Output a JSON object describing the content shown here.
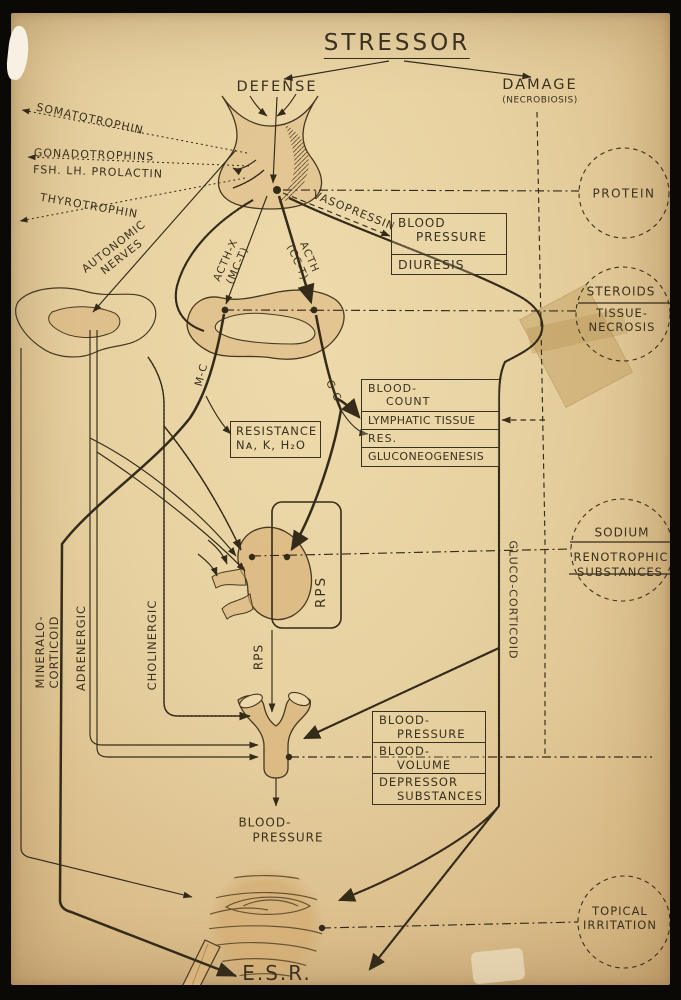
{
  "colors": {
    "paper": "#e7d1a1",
    "ink": "#352b1b",
    "organ_fill": "#d9b47c",
    "frame": "#0b0906"
  },
  "title": {
    "text": "STRESSOR"
  },
  "top": {
    "defense": "DEFENSE",
    "damage": "DAMAGE",
    "necrobiosis": "(NECROBIOSIS)"
  },
  "hormones": {
    "somatotrophin": "SOMATOTROPHIN",
    "gonadotrophins_l1": "GONADOTROPHINS",
    "gonadotrophins_l2": "FSH. LH. PROLACTIN",
    "thyrotrophin": "THYROTROPHIN",
    "vasopressin": "VASOPRESSIN",
    "acth_x_l1": "ACTH-X",
    "acth_x_l2": "(MC-T)",
    "acth_l1": "ACTH",
    "acth_l2": "(CC-T)"
  },
  "nerves": {
    "autonomic_l1": "AUTONOMIC",
    "autonomic_l2": "NERVES",
    "adrenergic": "ADRENERGIC",
    "cholinergic": "CHOLINERGIC"
  },
  "corticoids": {
    "mc": "M-C",
    "gc": "G-C",
    "mineralo_l1": "MINERALO-",
    "mineralo_l2": "CORTICOID",
    "gluco": "GLUCO-CORTICOID"
  },
  "rps": {
    "kidney": "RPS",
    "artery": "RPS"
  },
  "boxes": {
    "bp_diuresis": {
      "blood": "BLOOD",
      "pressure": "PRESSURE",
      "diuresis": "DIURESIS"
    },
    "blood_count": {
      "l1a": "BLOOD-",
      "l1b": "COUNT",
      "l2": "LYMPHATIC TISSUE",
      "l3": "RES.",
      "l4": "GLUCONEOGENESIS"
    },
    "resistance": {
      "l1": "RESISTANCE",
      "l2": "Nᴀ, K, H₂O"
    },
    "bp_volume": {
      "l1a": "BLOOD-",
      "l1b": "PRESSURE",
      "l2a": "BLOOD-",
      "l2b": "VOLUME",
      "l3a": "DEPRESSOR",
      "l3b": "SUBSTANCES"
    }
  },
  "effects": {
    "protein": "PROTEIN",
    "steroids": "STEROIDS",
    "tissue_l1": "TISSUE-",
    "tissue_l2": "NECROSIS",
    "sodium": "SODIUM",
    "reno_l1": "RENOTROPHIC",
    "reno_l2": "SUBSTANCES",
    "topical_l1": "TOPICAL",
    "topical_l2": "IRRITATION"
  },
  "bottom": {
    "bp_l1": "BLOOD-",
    "bp_l2": "PRESSURE",
    "esr": "E.S.R."
  }
}
